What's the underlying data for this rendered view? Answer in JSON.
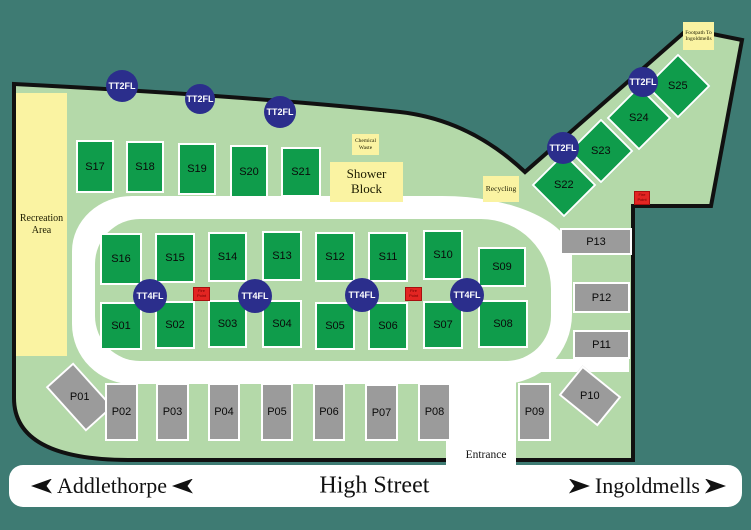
{
  "colors": {
    "background": "#3E7B73",
    "ground": "#B4D9A9",
    "plot_green": "#0F9C4B",
    "plot_gray": "#9B9B9B",
    "facility_yellow": "#FAF3A2",
    "tap_blue": "#2B2E8C",
    "fire_red": "#E32522",
    "road_white": "#FFFFFF",
    "outline_black": "#111111"
  },
  "street_bar": {
    "left_destination": "Addlethorpe",
    "street_name": "High Street",
    "right_destination": "Ingoldmells"
  },
  "entrance_label": "Entrance",
  "facilities": [
    {
      "label": "Recreation Area",
      "x": 16,
      "y": 93,
      "w": 51,
      "h": 263,
      "fs": 10
    },
    {
      "label": "Shower Block",
      "x": 330,
      "y": 162,
      "w": 73,
      "h": 40,
      "fs": 13
    },
    {
      "label": "Chemical Waste",
      "x": 352,
      "y": 134,
      "w": 27,
      "h": 21,
      "fs": 5.5
    },
    {
      "label": "Recycling",
      "x": 483,
      "y": 176,
      "w": 36,
      "h": 26,
      "fs": 7.5
    },
    {
      "label": "Footpath To Ingoldmells",
      "x": 683,
      "y": 22,
      "w": 31,
      "h": 28,
      "fs": 5.5
    }
  ],
  "pitches_green": [
    {
      "label": "S01",
      "x": 100,
      "y": 302,
      "w": 42,
      "h": 48
    },
    {
      "label": "S02",
      "x": 155,
      "y": 301,
      "w": 40,
      "h": 48
    },
    {
      "label": "S03",
      "x": 208,
      "y": 300,
      "w": 39,
      "h": 48
    },
    {
      "label": "S04",
      "x": 262,
      "y": 300,
      "w": 40,
      "h": 48
    },
    {
      "label": "S05",
      "x": 315,
      "y": 302,
      "w": 40,
      "h": 48
    },
    {
      "label": "S06",
      "x": 368,
      "y": 302,
      "w": 40,
      "h": 48
    },
    {
      "label": "S07",
      "x": 423,
      "y": 301,
      "w": 40,
      "h": 48
    },
    {
      "label": "S08",
      "x": 478,
      "y": 300,
      "w": 50,
      "h": 48
    },
    {
      "label": "S09",
      "x": 478,
      "y": 247,
      "w": 48,
      "h": 40
    },
    {
      "label": "S10",
      "x": 423,
      "y": 230,
      "w": 40,
      "h": 50
    },
    {
      "label": "S11",
      "x": 368,
      "y": 232,
      "w": 40,
      "h": 50
    },
    {
      "label": "S12",
      "x": 315,
      "y": 232,
      "w": 40,
      "h": 50
    },
    {
      "label": "S13",
      "x": 262,
      "y": 231,
      "w": 40,
      "h": 50
    },
    {
      "label": "S14",
      "x": 208,
      "y": 232,
      "w": 39,
      "h": 50
    },
    {
      "label": "S15",
      "x": 155,
      "y": 233,
      "w": 40,
      "h": 50
    },
    {
      "label": "S16",
      "x": 100,
      "y": 233,
      "w": 42,
      "h": 52
    },
    {
      "label": "S17",
      "x": 76,
      "y": 140,
      "w": 38,
      "h": 53
    },
    {
      "label": "S18",
      "x": 126,
      "y": 141,
      "w": 38,
      "h": 52
    },
    {
      "label": "S19",
      "x": 178,
      "y": 143,
      "w": 38,
      "h": 52
    },
    {
      "label": "S20",
      "x": 230,
      "y": 145,
      "w": 38,
      "h": 53
    },
    {
      "label": "S21",
      "x": 281,
      "y": 147,
      "w": 40,
      "h": 50
    },
    {
      "label": "S22",
      "x": 541,
      "y": 162,
      "w": 46,
      "h": 46,
      "rot": 45
    },
    {
      "label": "S23",
      "x": 578,
      "y": 128,
      "w": 46,
      "h": 46,
      "rot": 45
    },
    {
      "label": "S24",
      "x": 616,
      "y": 95,
      "w": 46,
      "h": 46,
      "rot": 45
    },
    {
      "label": "S25",
      "x": 655,
      "y": 63,
      "w": 46,
      "h": 46,
      "rot": 45
    }
  ],
  "pitches_gray": [
    {
      "label": "P01",
      "x": 61,
      "y": 367,
      "w": 37,
      "h": 60,
      "rot": -42
    },
    {
      "label": "P02",
      "x": 105,
      "y": 383,
      "w": 33,
      "h": 58
    },
    {
      "label": "P03",
      "x": 156,
      "y": 383,
      "w": 33,
      "h": 58
    },
    {
      "label": "P04",
      "x": 208,
      "y": 383,
      "w": 32,
      "h": 58
    },
    {
      "label": "P05",
      "x": 261,
      "y": 383,
      "w": 32,
      "h": 58
    },
    {
      "label": "P06",
      "x": 313,
      "y": 383,
      "w": 32,
      "h": 58
    },
    {
      "label": "P07",
      "x": 365,
      "y": 384,
      "w": 33,
      "h": 57
    },
    {
      "label": "P08",
      "x": 418,
      "y": 383,
      "w": 33,
      "h": 58
    },
    {
      "label": "P09",
      "x": 518,
      "y": 383,
      "w": 33,
      "h": 58
    },
    {
      "label": "P10",
      "x": 565,
      "y": 377,
      "w": 50,
      "h": 38,
      "rot": 39
    },
    {
      "label": "P11",
      "x": 573,
      "y": 330,
      "w": 57,
      "h": 29
    },
    {
      "label": "P12",
      "x": 573,
      "y": 282,
      "w": 57,
      "h": 31
    },
    {
      "label": "P13",
      "x": 560,
      "y": 228,
      "w": 72,
      "h": 27
    }
  ],
  "water_taps": [
    {
      "label": "TT2FL",
      "cx": 122,
      "cy": 86,
      "r": 16
    },
    {
      "label": "TT2FL",
      "cx": 200,
      "cy": 99,
      "r": 15
    },
    {
      "label": "TT2FL",
      "cx": 280,
      "cy": 112,
      "r": 16
    },
    {
      "label": "TT2FL",
      "cx": 563,
      "cy": 148,
      "r": 16
    },
    {
      "label": "TT2FL",
      "cx": 643,
      "cy": 82,
      "r": 15
    },
    {
      "label": "TT4FL",
      "cx": 150,
      "cy": 296,
      "r": 17
    },
    {
      "label": "TT4FL",
      "cx": 255,
      "cy": 296,
      "r": 17
    },
    {
      "label": "TT4FL",
      "cx": 362,
      "cy": 295,
      "r": 17
    },
    {
      "label": "TT4FL",
      "cx": 467,
      "cy": 295,
      "r": 17
    }
  ],
  "fire_points": [
    {
      "label": "Fire Point",
      "x": 193,
      "y": 287,
      "w": 17,
      "h": 14
    },
    {
      "label": "Fire Point",
      "x": 405,
      "y": 287,
      "w": 17,
      "h": 14
    },
    {
      "label": "Fire Point",
      "x": 634,
      "y": 191,
      "w": 16,
      "h": 14
    }
  ]
}
